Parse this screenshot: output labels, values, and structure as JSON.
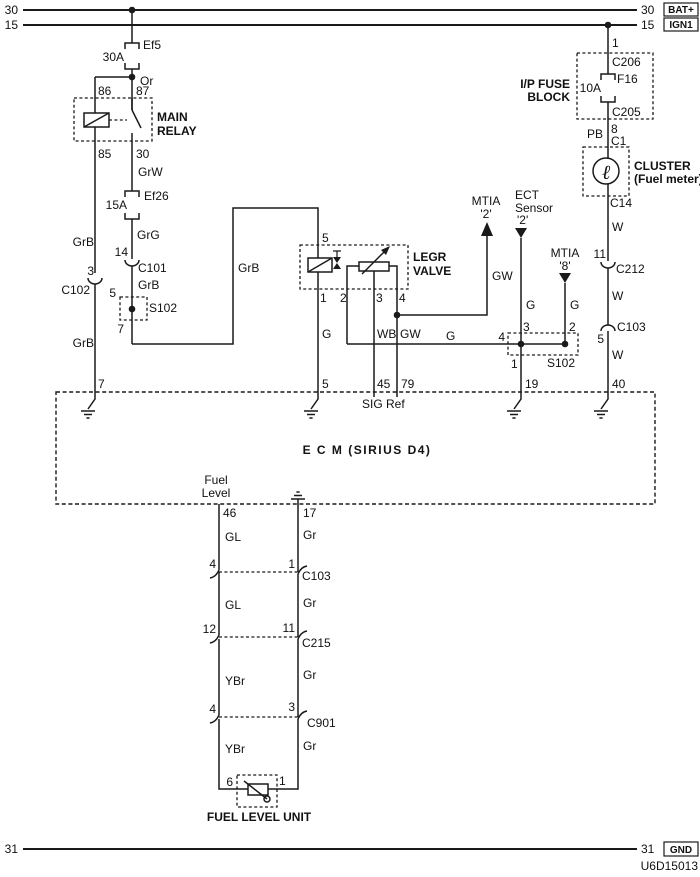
{
  "colors": {
    "ink": "#1a1a1a",
    "paper": "#ffffff"
  },
  "doc_number": "U6D15013",
  "rails": {
    "bat": {
      "left": "30",
      "right": "30",
      "tag": "BAT+"
    },
    "ign": {
      "left": "15",
      "right": "15",
      "tag": "IGN1"
    },
    "gnd": {
      "left": "31",
      "right": "31",
      "tag": "GND"
    }
  },
  "fuses": {
    "ef5": {
      "name": "Ef5",
      "rating": "30A"
    },
    "ef26": {
      "name": "Ef26",
      "rating": "15A"
    },
    "f16": {
      "name": "F16",
      "rating": "10A"
    }
  },
  "main_relay": {
    "name1": "MAIN",
    "name2": "RELAY",
    "wire_or": "Or",
    "pin86": "86",
    "pin87": "87",
    "pin85": "85",
    "pin30": "30"
  },
  "left_branch": {
    "wire_grb1": "GrB",
    "pin3": "3",
    "conn_c102": "C102",
    "wire_grb2": "GrB",
    "pin7": "7"
  },
  "mid_branch": {
    "wire_grw": "GrW",
    "wire_grg": "GrG",
    "pin14": "14",
    "conn_c101": "C101",
    "wire_grb": "GrB",
    "pin5": "5",
    "splice": "S102",
    "pin7": "7",
    "wire_grb_riser": "GrB"
  },
  "egr_valve": {
    "name1": "LEGR",
    "name2": "VALVE",
    "pin5": "5",
    "pin1": "1",
    "pin2": "2",
    "pin3": "3",
    "pin4": "4",
    "wire_g": "G",
    "wire_wb": "WB",
    "wire_gw": "GW",
    "wire_g_run": "G"
  },
  "mtia2": {
    "name": "MTIA",
    "ref": "'2'",
    "wire_gw": "GW"
  },
  "ect_sensor": {
    "name1": "ECT",
    "name2": "Sensor",
    "ref": "'2'",
    "wire_g": "G",
    "pin3": "3"
  },
  "mtia8": {
    "name": "MTIA",
    "ref": "'8'",
    "wire_g": "G",
    "pin2": "2"
  },
  "splice_s102": {
    "pin4": "4",
    "pin1": "1",
    "name": "S102"
  },
  "ip_fuse_block": {
    "name1": "I/P FUSE",
    "name2": "BLOCK",
    "pin1": "1",
    "conn_c206": "C206",
    "conn_c205": "C205"
  },
  "cluster": {
    "wire_pb": "PB",
    "pin8": "8",
    "conn_c1": "C1",
    "name1": "CLUSTER",
    "name2": "(Fuel meter)",
    "gauge_glyph": "ℓ",
    "conn_c14": "C14"
  },
  "right_branch": {
    "wire_w1": "W",
    "pin11": "11",
    "conn_c212": "C212",
    "wire_w2": "W",
    "conn_c103": "C103",
    "pin5": "5",
    "wire_w3": "W"
  },
  "ecm": {
    "title": "E C M (SIRIUS D4)",
    "sig_ref": "SIG Ref",
    "pin7": "7",
    "pin5": "5",
    "pin45": "45",
    "pin79": "79",
    "pin19": "19",
    "pin40": "40",
    "fuel1": "Fuel",
    "fuel2": "Level",
    "pin46": "46",
    "pin17": "17"
  },
  "fuel_circuit": {
    "wire_gl1": "GL",
    "wire_gr1": "Gr",
    "pin4a": "4",
    "pin1a": "1",
    "conn_c103": "C103",
    "wire_gl2": "GL",
    "wire_gr2": "Gr",
    "pin12": "12",
    "pin11": "11",
    "conn_c215": "C215",
    "wire_ybr1": "YBr",
    "wire_gr3": "Gr",
    "pin4b": "4",
    "pin3b": "3",
    "conn_c901": "C901",
    "wire_ybr2": "YBr",
    "wire_gr4": "Gr",
    "pin6": "6",
    "pin1b": "1",
    "unit_name": "FUEL LEVEL UNIT"
  }
}
